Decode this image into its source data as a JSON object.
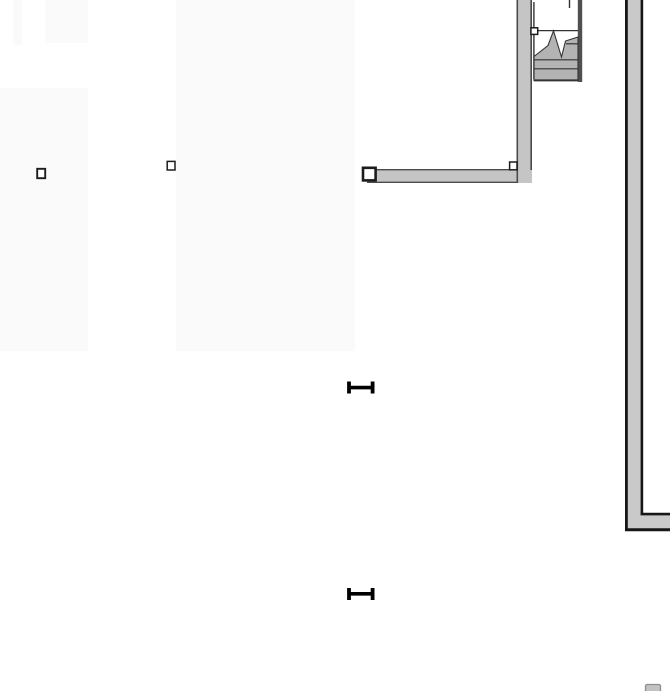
{
  "canvas": {
    "width": 670,
    "height": 691,
    "background": "#ffffff"
  },
  "palette": {
    "room_fill": "#fafafa",
    "wall_fill": "#c5c5c5",
    "wall_fill_light": "#c9c9c9",
    "wall_edge": "#4a4a4a",
    "black_edge": "#161616",
    "stair_fill": "#b3b3b3",
    "stair_edge": "#333333",
    "stair_bar": "#4f4f4f",
    "grip_stroke": "#1c1c1c",
    "grip_fill": "#ffffff",
    "marker_black": "#000000",
    "blob_fill": "#c2c2c2",
    "blob_edge": "#8e8e8e"
  },
  "layers": [
    {
      "name": "room-areas",
      "interactable": true,
      "shapes": [
        {
          "kind": "rect",
          "name": "room-fill-1",
          "interactable": true,
          "x": 13,
          "y": 0,
          "w": 9,
          "h": 45,
          "fill": "room_fill"
        },
        {
          "kind": "rect",
          "name": "room-fill-2",
          "interactable": true,
          "x": 45,
          "y": 0,
          "w": 43,
          "h": 43,
          "fill": "room_fill"
        },
        {
          "kind": "rect",
          "name": "room-fill-3",
          "interactable": true,
          "x": 0,
          "y": 88,
          "w": 88,
          "h": 263,
          "fill": "room_fill"
        },
        {
          "kind": "rect",
          "name": "room-fill-4",
          "interactable": true,
          "x": 176,
          "y": 0,
          "w": 179,
          "h": 351,
          "fill": "room_fill"
        }
      ]
    },
    {
      "name": "walls",
      "interactable": true,
      "shapes": [
        {
          "kind": "rect",
          "name": "wall-horizontal-fill",
          "interactable": true,
          "x": 367,
          "y": 169,
          "w": 165,
          "h": 14,
          "fill": "wall_fill"
        },
        {
          "kind": "line",
          "name": "wall-horizontal-top-edge",
          "interactable": false,
          "x1": 367,
          "y1": 169.7,
          "x2": 532,
          "y2": 169.7,
          "stroke": "wall_edge",
          "sw": 1.4
        },
        {
          "kind": "line",
          "name": "wall-horizontal-bottom-edge",
          "interactable": false,
          "x1": 367,
          "y1": 182.3,
          "x2": 532,
          "y2": 182.3,
          "stroke": "wall_edge",
          "sw": 1.4
        },
        {
          "kind": "rect",
          "name": "wall-vertical-fill",
          "interactable": true,
          "x": 516.5,
          "y": 0,
          "w": 15.5,
          "h": 183,
          "fill": "wall_fill"
        },
        {
          "kind": "line",
          "name": "wall-vertical-left-edge",
          "interactable": false,
          "x1": 517.3,
          "y1": 0,
          "x2": 517.3,
          "y2": 183,
          "stroke": "wall_edge",
          "sw": 1.6
        },
        {
          "kind": "line",
          "name": "wall-vertical-right-edge",
          "interactable": false,
          "x1": 531.2,
          "y1": 0,
          "x2": 531.2,
          "y2": 170,
          "stroke": "wall_edge",
          "sw": 1.6
        },
        {
          "kind": "polygon",
          "name": "corner-wall-fill",
          "interactable": true,
          "points": [
            [
              627,
              0
            ],
            [
              641,
              0
            ],
            [
              641,
              515
            ],
            [
              670,
              515
            ],
            [
              670,
              529
            ],
            [
              627,
              529
            ]
          ],
          "fill": "wall_fill_light"
        },
        {
          "kind": "line",
          "name": "corner-wall-outer-left-edge",
          "interactable": false,
          "x1": 626.4,
          "y1": 0,
          "x2": 626.4,
          "y2": 530.6,
          "stroke": "black_edge",
          "sw": 2.8
        },
        {
          "kind": "line",
          "name": "corner-wall-inner-right-edge",
          "interactable": false,
          "x1": 641.9,
          "y1": 0,
          "x2": 641.9,
          "y2": 514.5,
          "stroke": "black_edge",
          "sw": 2.6
        },
        {
          "kind": "line",
          "name": "corner-wall-inner-top-edge",
          "interactable": false,
          "x1": 640.6,
          "y1": 514.1,
          "x2": 670,
          "y2": 514.1,
          "stroke": "black_edge",
          "sw": 2.6
        },
        {
          "kind": "line",
          "name": "corner-wall-bottom-edge",
          "interactable": false,
          "x1": 625,
          "y1": 529.7,
          "x2": 670,
          "y2": 529.7,
          "stroke": "black_edge",
          "sw": 3
        }
      ]
    },
    {
      "name": "staircase",
      "interactable": true,
      "shapes": [
        {
          "kind": "line",
          "name": "stair-left-stringer",
          "interactable": true,
          "x1": 533.9,
          "y1": 2,
          "x2": 533.9,
          "y2": 79,
          "stroke": "stair_edge",
          "sw": 1.4
        },
        {
          "kind": "line",
          "name": "stair-top-stub",
          "interactable": false,
          "x1": 569.5,
          "y1": 0,
          "x2": 569.5,
          "y2": 8,
          "stroke": "stair_edge",
          "sw": 1.4
        },
        {
          "kind": "rect",
          "name": "stair-right-stringer",
          "interactable": true,
          "x": 577.8,
          "y": 0,
          "w": 4.4,
          "h": 82,
          "fill": "stair_bar"
        },
        {
          "kind": "line",
          "name": "stair-landing-line",
          "interactable": false,
          "x1": 534,
          "y1": 30.6,
          "x2": 578,
          "y2": 30.6,
          "stroke": "stair_edge",
          "sw": 1.2
        },
        {
          "kind": "polygon",
          "name": "stair-breakline-fill",
          "interactable": true,
          "points": [
            [
              534,
              56.5
            ],
            [
              548,
              45.5
            ],
            [
              553.5,
              30.8
            ],
            [
              561.5,
              57
            ],
            [
              565.5,
              41
            ],
            [
              578,
              37
            ],
            [
              578,
              80.5
            ],
            [
              534,
              80.5
            ]
          ],
          "fill": "stair_fill",
          "stroke": "stair_edge",
          "sw": 1.1
        },
        {
          "kind": "line",
          "name": "stair-tread-line-1",
          "interactable": false,
          "x1": 534,
          "y1": 59.8,
          "x2": 578,
          "y2": 59.8,
          "stroke": "stair_edge",
          "sw": 1.2
        },
        {
          "kind": "line",
          "name": "stair-tread-line-2",
          "interactable": false,
          "x1": 534,
          "y1": 68.8,
          "x2": 578,
          "y2": 68.8,
          "stroke": "stair_edge",
          "sw": 1.2
        },
        {
          "kind": "line",
          "name": "stair-tread-line-3",
          "interactable": false,
          "x1": 566,
          "y1": 43.8,
          "x2": 578,
          "y2": 43.8,
          "stroke": "stair_edge",
          "sw": 1.2
        },
        {
          "kind": "line",
          "name": "stair-bottom-edge",
          "interactable": false,
          "x1": 534,
          "y1": 80.4,
          "x2": 578,
          "y2": 80.4,
          "stroke": "stair_edge",
          "sw": 2
        }
      ]
    },
    {
      "name": "furniture",
      "interactable": true,
      "shapes": [
        {
          "kind": "rect",
          "name": "furniture-item-partial",
          "interactable": true,
          "x": 645.5,
          "y": 684.5,
          "w": 15,
          "h": 8,
          "rx": 1.5,
          "fill": "blob_fill",
          "stroke": "blob_edge",
          "sw": 1.3
        }
      ]
    },
    {
      "name": "passage-markers",
      "interactable": true,
      "shapes": [
        {
          "kind": "line",
          "name": "passage-marker-1-left-cap",
          "interactable": true,
          "x1": 349,
          "y1": 381.5,
          "x2": 349,
          "y2": 393.5,
          "stroke": "marker_black",
          "sw": 3.8
        },
        {
          "kind": "line",
          "name": "passage-marker-1-right-cap",
          "interactable": true,
          "x1": 372.6,
          "y1": 381.5,
          "x2": 372.6,
          "y2": 393.5,
          "stroke": "marker_black",
          "sw": 3.8
        },
        {
          "kind": "line",
          "name": "passage-marker-1-crossbar",
          "interactable": true,
          "x1": 348,
          "y1": 387.6,
          "x2": 374,
          "y2": 387.6,
          "stroke": "marker_black",
          "sw": 3.6
        },
        {
          "kind": "line",
          "name": "passage-marker-2-left-cap",
          "interactable": true,
          "x1": 349,
          "y1": 588,
          "x2": 349,
          "y2": 600,
          "stroke": "marker_black",
          "sw": 3.8
        },
        {
          "kind": "line",
          "name": "passage-marker-2-right-cap",
          "interactable": true,
          "x1": 372.6,
          "y1": 588,
          "x2": 372.6,
          "y2": 600,
          "stroke": "marker_black",
          "sw": 3.8
        },
        {
          "kind": "line",
          "name": "passage-marker-2-crossbar",
          "interactable": true,
          "x1": 348,
          "y1": 593.8,
          "x2": 374,
          "y2": 593.8,
          "stroke": "marker_black",
          "sw": 3.6
        }
      ]
    },
    {
      "name": "selection-grips",
      "interactable": true,
      "shapes": [
        {
          "kind": "rect",
          "name": "selection-grip-free-1",
          "interactable": true,
          "x": 37.2,
          "y": 168.8,
          "w": 8,
          "h": 9.4,
          "fill": "grip_fill",
          "stroke": "grip_stroke",
          "sw": 1.9
        },
        {
          "kind": "rect",
          "name": "selection-grip-free-2",
          "interactable": true,
          "x": 167.2,
          "y": 161.4,
          "w": 7.8,
          "h": 8.6,
          "fill": "grip_fill",
          "stroke": "grip_stroke",
          "sw": 1.5
        },
        {
          "kind": "rect",
          "name": "selection-grip-wall-left-end",
          "interactable": true,
          "x": 363,
          "y": 167.8,
          "w": 12.6,
          "h": 12.6,
          "fill": "grip_fill",
          "stroke": "grip_stroke",
          "sw": 2.6
        },
        {
          "kind": "rect",
          "name": "selection-grip-wall-corner",
          "interactable": true,
          "x": 509.6,
          "y": 162,
          "w": 7.4,
          "h": 7.8,
          "fill": "grip_fill",
          "stroke": "grip_stroke",
          "sw": 1.5
        },
        {
          "kind": "rect",
          "name": "selection-grip-stair",
          "interactable": true,
          "x": 530.9,
          "y": 27.8,
          "w": 6.8,
          "h": 6.6,
          "fill": "grip_fill",
          "stroke": "grip_stroke",
          "sw": 1.5
        }
      ]
    }
  ]
}
